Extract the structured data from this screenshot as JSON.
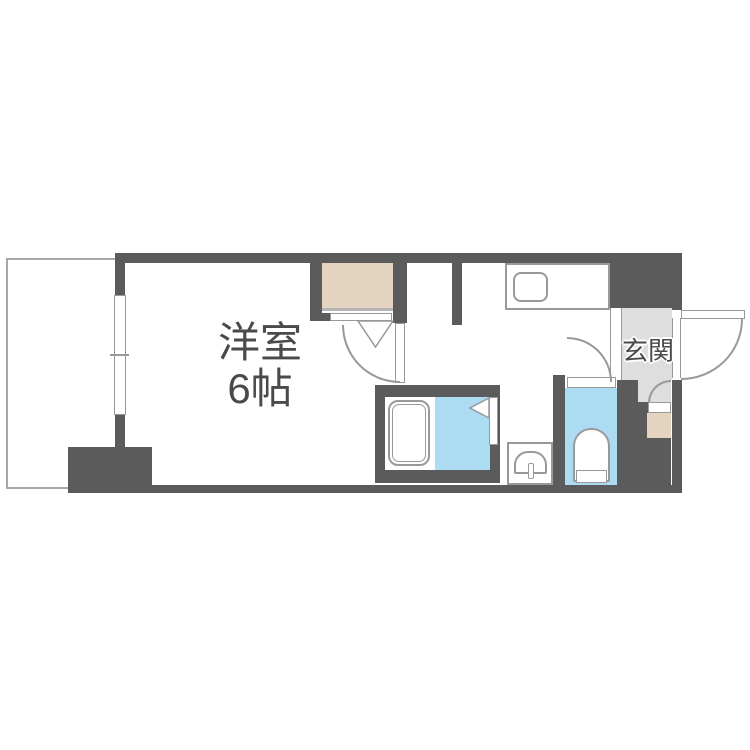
{
  "page": {
    "width": 750,
    "height": 750,
    "background": "#ffffff"
  },
  "labels": {
    "room_name": "洋室",
    "room_size": "6帖",
    "entrance": "玄関"
  },
  "colors": {
    "wall": "#5b5b5b",
    "closet_fill": "#e4d3be",
    "water_fill": "#abdcf2",
    "entrance_floor": "#dedede",
    "outline": "#999999",
    "balcony_line": "#a8a8a8",
    "label_text": "#4a4a4a"
  },
  "fixtures": [
    {
      "name": "balcony"
    },
    {
      "name": "window"
    },
    {
      "name": "closet"
    },
    {
      "name": "kitchen-counter"
    },
    {
      "name": "kitchen-sink"
    },
    {
      "name": "bathtub"
    },
    {
      "name": "bathroom-folding-door"
    },
    {
      "name": "washbasin"
    },
    {
      "name": "toilet"
    },
    {
      "name": "toilet-door"
    },
    {
      "name": "room-door"
    },
    {
      "name": "entrance-door"
    },
    {
      "name": "shoe-cabinet"
    },
    {
      "name": "shoe-cabinet-door"
    }
  ]
}
